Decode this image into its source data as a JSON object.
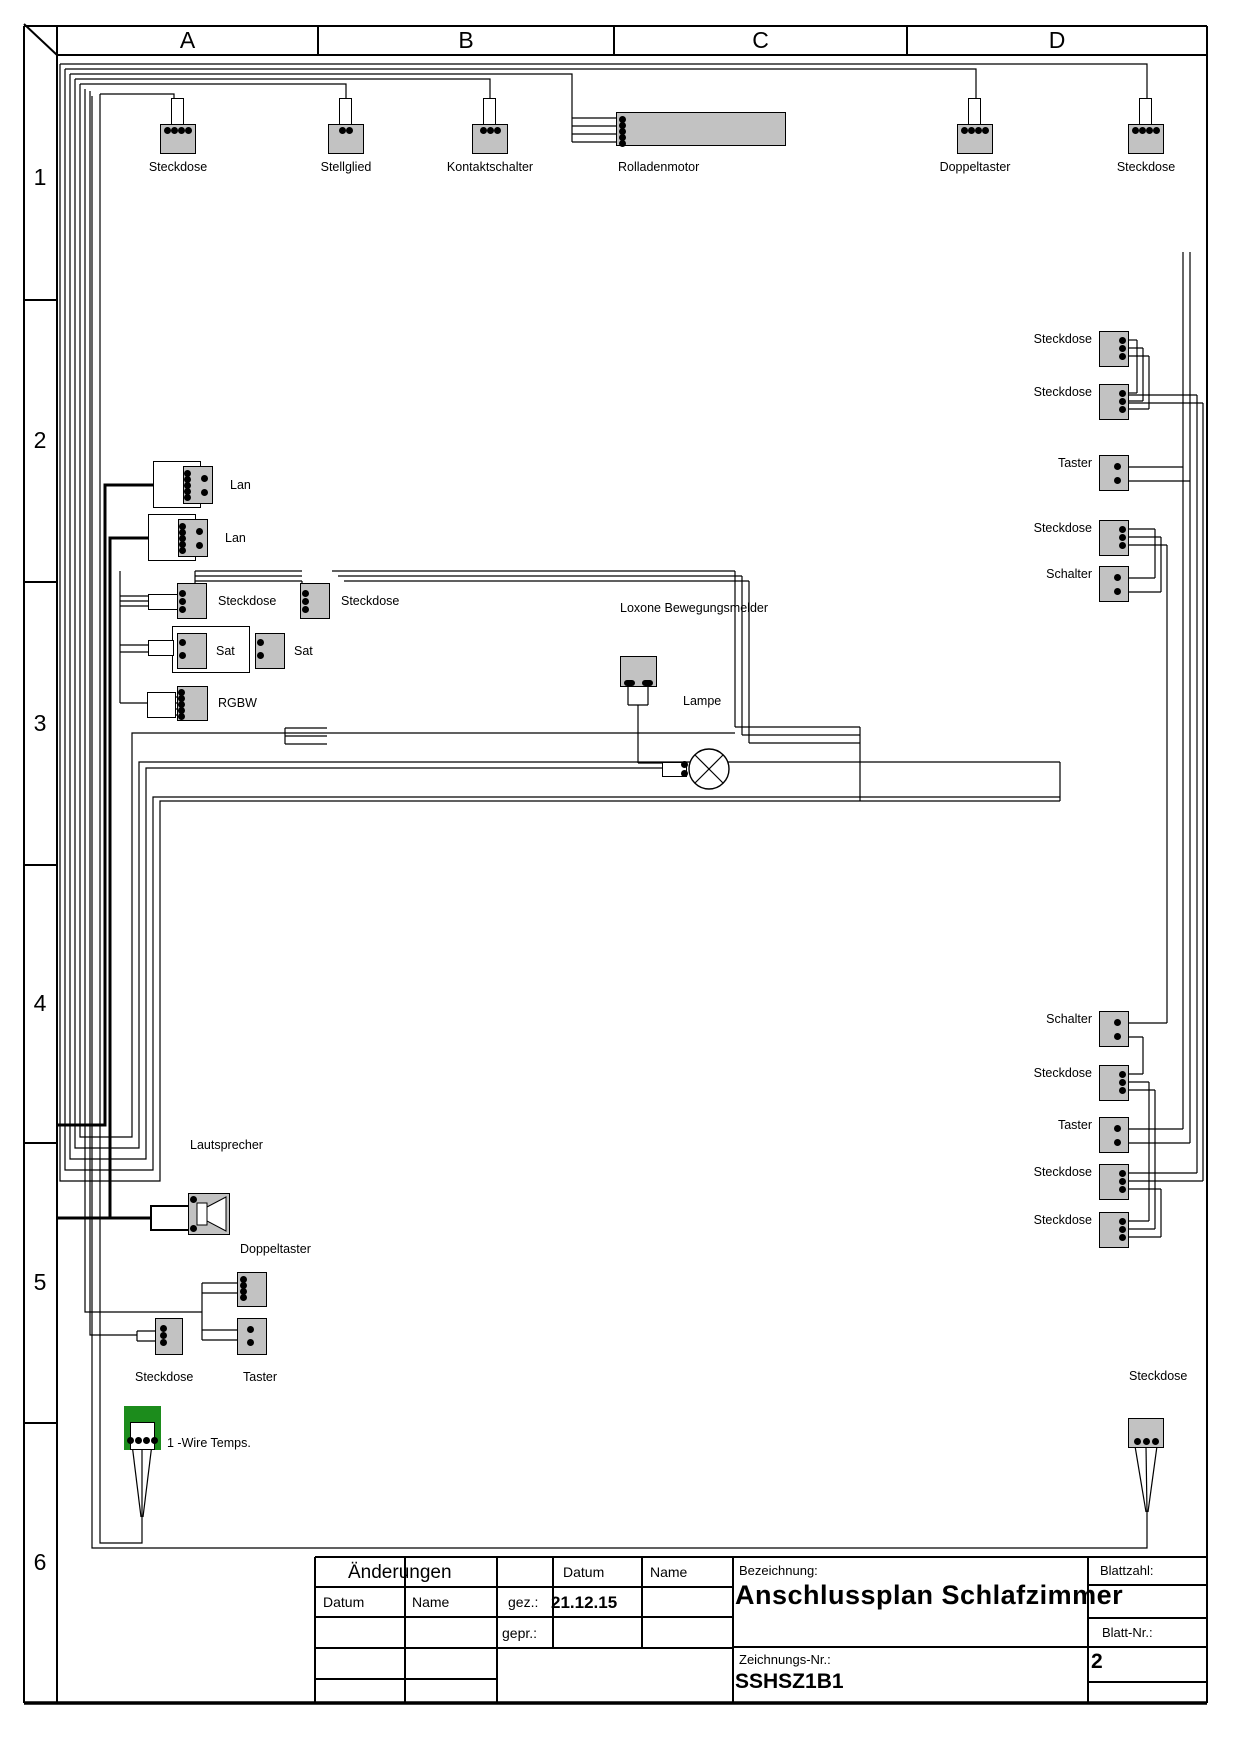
{
  "grid": {
    "columns": [
      "A",
      "B",
      "C",
      "D"
    ],
    "rows": [
      "1",
      "2",
      "3",
      "4",
      "5",
      "6"
    ]
  },
  "colors": {
    "component_fill": "#c2c2c2",
    "onewire_green": "#1c8c1c",
    "line": "#000000"
  },
  "components": [
    {
      "id": "steckdose-a1",
      "label": "Steckdose",
      "type": "top",
      "x": 160,
      "y": 124,
      "dots": 4
    },
    {
      "id": "stellglied",
      "label": "Stellglied",
      "type": "top",
      "x": 328,
      "y": 124,
      "dots": 2
    },
    {
      "id": "kontaktschalter",
      "label": "Kontaktschalter",
      "type": "top",
      "x": 472,
      "y": 124,
      "dots": 3
    },
    {
      "id": "rolladenmotor",
      "label": "Rolladenmotor",
      "type": "motor",
      "x": 616,
      "y": 112
    },
    {
      "id": "doppeltaster-d1",
      "label": "Doppeltaster",
      "type": "top",
      "x": 957,
      "y": 124,
      "dots": 4
    },
    {
      "id": "steckdose-d1",
      "label": "Steckdose",
      "type": "top",
      "x": 1128,
      "y": 124,
      "dots": 4
    },
    {
      "id": "lan-1",
      "label": "Lan",
      "type": "lan",
      "x": 153,
      "y": 461
    },
    {
      "id": "lan-2",
      "label": "Lan",
      "type": "lan",
      "x": 148,
      "y": 514
    },
    {
      "id": "steckdose-3a",
      "label": "Steckdose",
      "type": "sockleft",
      "x": 177,
      "y": 583,
      "stub": true
    },
    {
      "id": "steckdose-3b",
      "label": "Steckdose",
      "type": "sockleft",
      "x": 300,
      "y": 583,
      "stub": false
    },
    {
      "id": "sat-pair",
      "label": "Sat",
      "label2": "Sat",
      "type": "sat",
      "x": 172,
      "y": 626
    },
    {
      "id": "rgbw",
      "label": "RGBW",
      "type": "rgbw",
      "x": 147,
      "y": 686
    },
    {
      "id": "bewegungsmelder",
      "label": "Loxone Bewegungsmelder",
      "type": "melder",
      "x": 620,
      "y": 656
    },
    {
      "id": "lampe",
      "label": "Lampe",
      "type": "lamp",
      "x": 662,
      "y": 749
    },
    {
      "id": "steckdose-r1",
      "label": "Steckdose",
      "type": "right",
      "x": 1099,
      "y": 331,
      "dots": 3
    },
    {
      "id": "steckdose-r2",
      "label": "Steckdose",
      "type": "right",
      "x": 1099,
      "y": 384,
      "dots": 3
    },
    {
      "id": "taster-r1",
      "label": "Taster",
      "type": "right",
      "x": 1099,
      "y": 455,
      "dots": 2
    },
    {
      "id": "steckdose-r3",
      "label": "Steckdose",
      "type": "right",
      "x": 1099,
      "y": 520,
      "dots": 3
    },
    {
      "id": "schalter-r1",
      "label": "Schalter",
      "type": "right",
      "x": 1099,
      "y": 566,
      "dots": 2
    },
    {
      "id": "schalter-r2",
      "label": "Schalter",
      "type": "right",
      "x": 1099,
      "y": 1011,
      "dots": 2
    },
    {
      "id": "steckdose-r4",
      "label": "Steckdose",
      "type": "right",
      "x": 1099,
      "y": 1065,
      "dots": 3
    },
    {
      "id": "taster-r2",
      "label": "Taster",
      "type": "right",
      "x": 1099,
      "y": 1117,
      "dots": 2
    },
    {
      "id": "steckdose-r5",
      "label": "Steckdose",
      "type": "right",
      "x": 1099,
      "y": 1164,
      "dots": 3
    },
    {
      "id": "steckdose-r6",
      "label": "Steckdose",
      "type": "right",
      "x": 1099,
      "y": 1212,
      "dots": 3
    },
    {
      "id": "lautsprecher",
      "label": "Lautsprecher",
      "type": "speaker",
      "x": 150,
      "y": 1193
    },
    {
      "id": "doppeltaster-5",
      "label": "Doppeltaster",
      "type": "left4",
      "x": 237,
      "y": 1272
    },
    {
      "id": "taster-5",
      "label": "Taster",
      "type": "center2",
      "x": 237,
      "y": 1318
    },
    {
      "id": "steckdose-5",
      "label": "Steckdose",
      "type": "sockleft3",
      "x": 155,
      "y": 1318
    },
    {
      "id": "onewire",
      "label": "1 -Wire Temps.",
      "type": "onewire",
      "x": 124,
      "y": 1406
    },
    {
      "id": "steckdose-6r",
      "label": "Steckdose",
      "type": "bottom",
      "x": 1128,
      "y": 1418,
      "dots": 3
    }
  ],
  "title_block": {
    "aenderungen": "Änderungen",
    "datum": "Datum",
    "name": "Name",
    "gez": "gez.:",
    "gepr": "gepr.:",
    "gez_datum": "21.12.15",
    "bezeichnung_label": "Bezeichnung:",
    "bezeichnung": "Anschlussplan Schlafzimmer",
    "zeichnungs_label": "Zeichnungs-Nr.:",
    "zeichnungs_nr": "SSHSZ1B1",
    "blattzahl_label": "Blattzahl:",
    "blattnr_label": "Blatt-Nr.:",
    "blattnr": "2"
  }
}
